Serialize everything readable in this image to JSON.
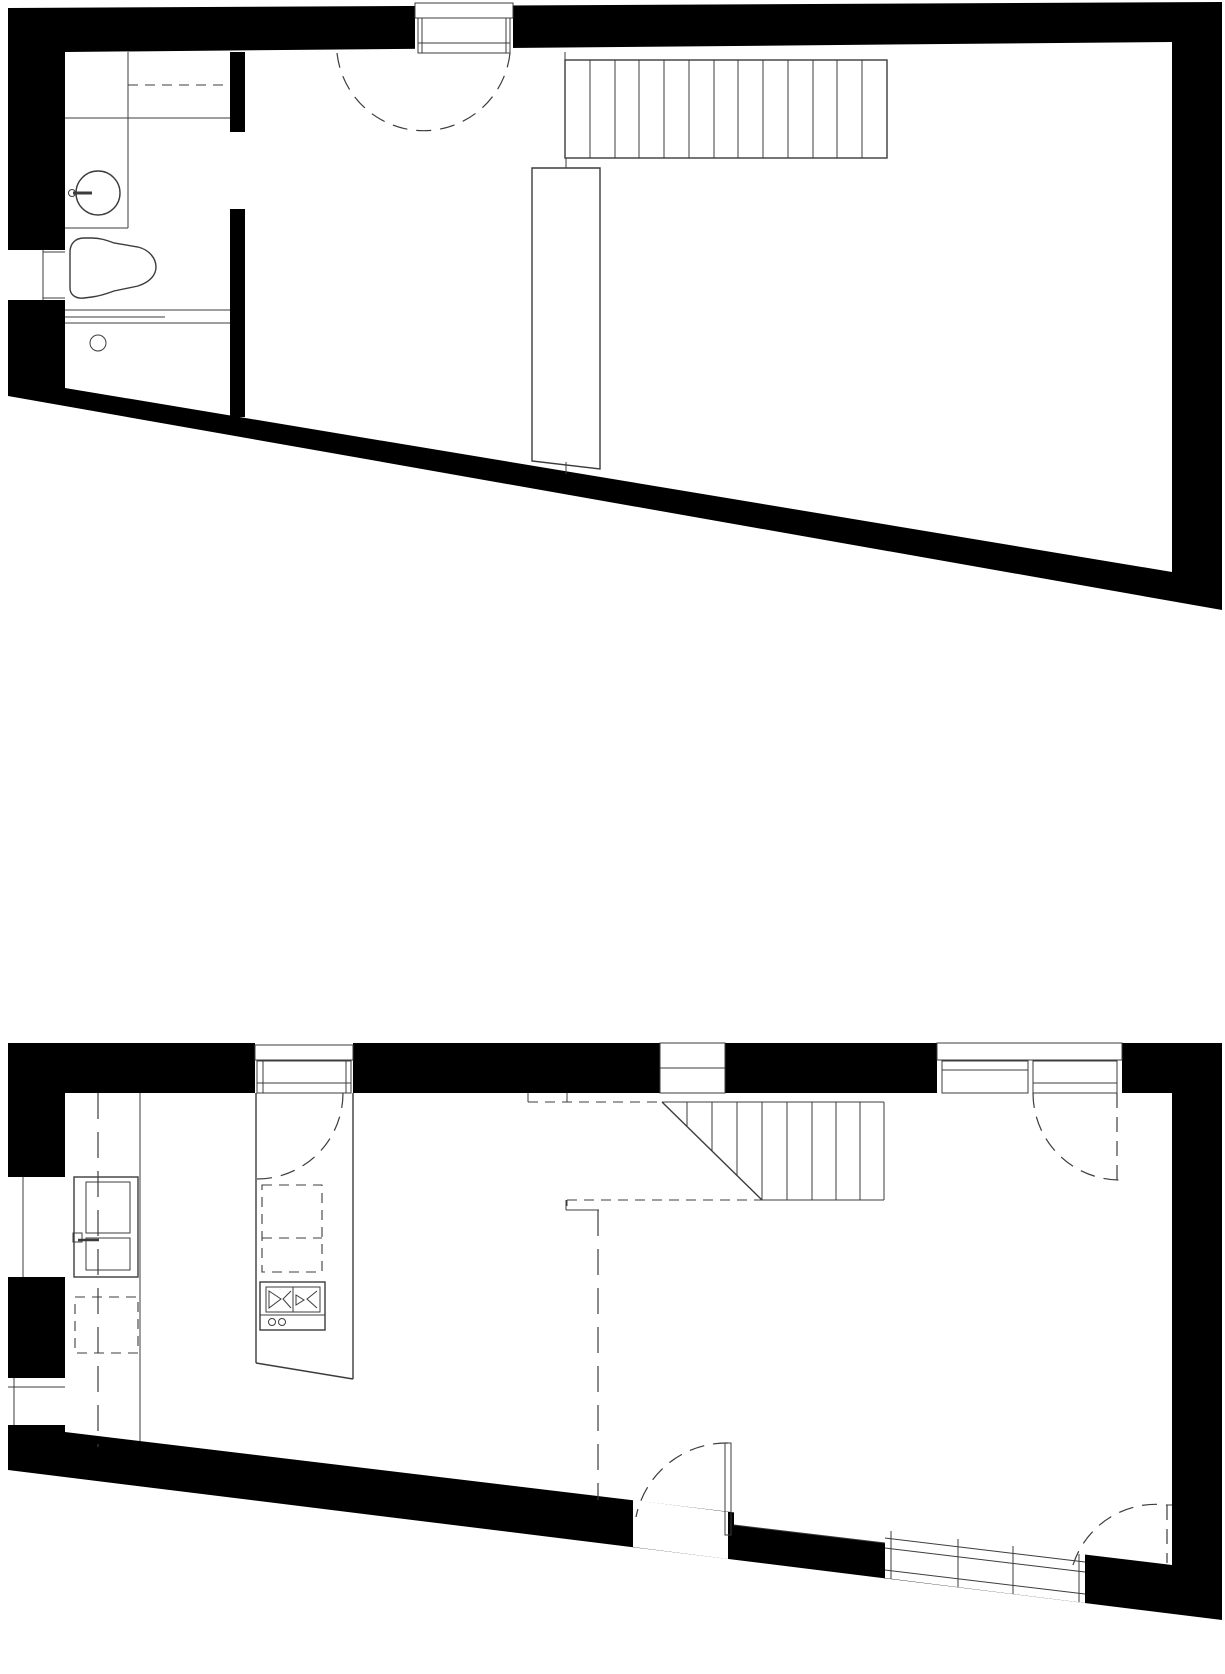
{
  "page": {
    "kind": "architectural-floor-plan-drawing",
    "sheet_background": "#ffffff",
    "text_content": "none — drawing contains no visible text or dimensions"
  },
  "colors": {
    "wall_poche": "#000000",
    "line": "#3c3c3c",
    "floor": "#ffffff"
  },
  "drawing": {
    "plans": [
      {
        "id": "upper-floor-plan",
        "position": "top half of sheet",
        "shape": "tapered rectangle, bottom wall slopes down to the right",
        "elements": [
          "solid black exterior walls",
          "top-wall window with frame and mullion",
          "dashed semicircular door swing arc",
          "bathroom partition wall with door opening",
          "vanity counter with dashed shelf line",
          "washbasin circle with faucet",
          "toilet",
          "shower threshold lines",
          "floor drain circle",
          "left-wall opening",
          "staircase with 13 treads",
          "tall wardrobe volume with slanted base"
        ]
      },
      {
        "id": "ground-floor-plan",
        "position": "bottom half of sheet",
        "shape": "tapered rectangle, bottom wall slopes down to the right",
        "elements": [
          "solid black exterior walls",
          "left entry door drawn in elevation with handle",
          "kitchen window with quarter-circle dashed swing arc",
          "small top-wall window",
          "french window with two panes and dashed swing arc",
          "kitchen island with gas cooktop and two control knobs",
          "dashed overhead-cabinet projection rectangles",
          "dashed upper-floor projection lines",
          "staircase with 45-degree cut line and 8 treads",
          "bottom-wall door with open leaf and dashed swing arc",
          "bottom-wall window band with mullions",
          "bottom-right dashed door swing arc",
          "left-wall low opening"
        ]
      }
    ]
  }
}
